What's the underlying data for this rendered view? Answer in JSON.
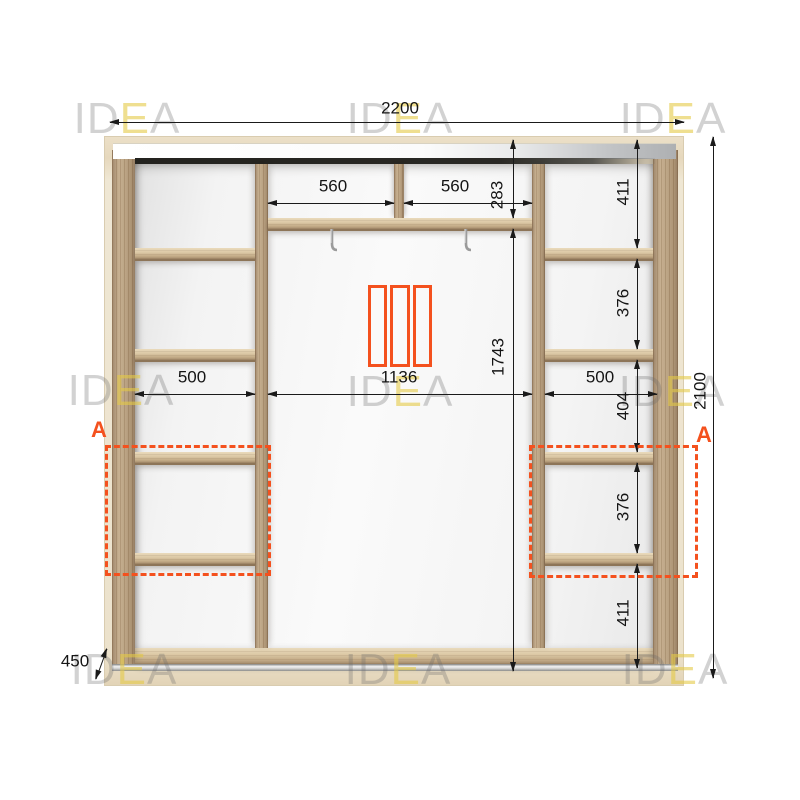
{
  "watermark": {
    "prefix": "ID",
    "accent": "E",
    "suffix": "A"
  },
  "dimensions": {
    "total_width": "2200",
    "total_height": "2100",
    "depth": "450",
    "top_shelf_left": "560",
    "top_shelf_right": "560",
    "top_section_height": "283",
    "left_column_width": "500",
    "center_width": "1136",
    "right_column_width": "500",
    "hanging_height": "1743",
    "right_column_cells": [
      "411",
      "376",
      "404",
      "376",
      "411"
    ]
  },
  "annotations": {
    "section_label_left": "A",
    "section_label_right": "A"
  },
  "icons": {
    "sliding_doors_icon": "three-panel-sliding-door",
    "hanger_hook_icon": "metal-hook"
  },
  "colors": {
    "accent_orange": "#F4511E",
    "dimension_line": "#1A1A1A",
    "wood_light": "#C4AC8B",
    "frame_cream": "#EFE7D4",
    "watermark_gray": "#DADADA",
    "watermark_yellow": "#F1E6A8"
  }
}
